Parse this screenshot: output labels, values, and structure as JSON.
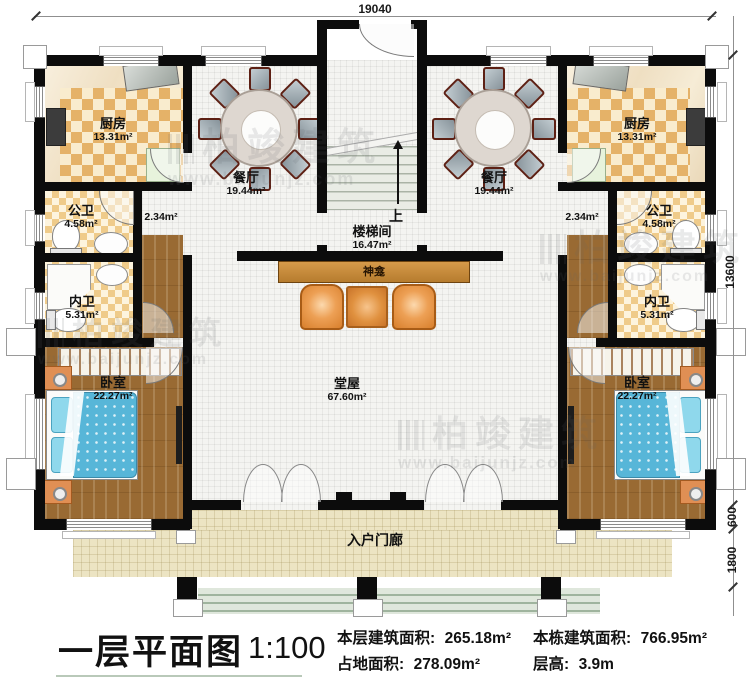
{
  "dimensions": {
    "top": "19040",
    "side_main": "13600",
    "side_porch": "600",
    "side_steps": "1800"
  },
  "rooms": {
    "kitchen": {
      "name": "厨房",
      "area": "13.31m²"
    },
    "dining": {
      "name": "餐厅",
      "area": "19.44m²"
    },
    "public_bath": {
      "name": "公卫",
      "area": "4.58m²"
    },
    "private_bath": {
      "name": "内卫",
      "area": "5.31m²"
    },
    "bedroom": {
      "name": "卧室",
      "area": "22.27m²"
    },
    "stairwell": {
      "name": "楼梯间",
      "area": "16.47m²"
    },
    "hall": {
      "name": "堂屋",
      "area": "67.60m²"
    },
    "corridor": {
      "area": "2.34m²"
    },
    "porch": {
      "name": "入户门廊"
    },
    "shrine": {
      "name": "神龛"
    },
    "stairs_up": "上"
  },
  "watermark": {
    "brand": "柏竣建筑",
    "url": "www.baijunjz.com"
  },
  "title_block": {
    "title": "一层平面图",
    "scale": "1:100",
    "stats": [
      {
        "label": "本层建筑面积:",
        "value": "265.18m²"
      },
      {
        "label": "占地面积:",
        "value": "278.09m²"
      },
      {
        "label": "本栋建筑面积:",
        "value": "766.95m²"
      },
      {
        "label": "层高:",
        "value": "3.9m"
      }
    ]
  }
}
